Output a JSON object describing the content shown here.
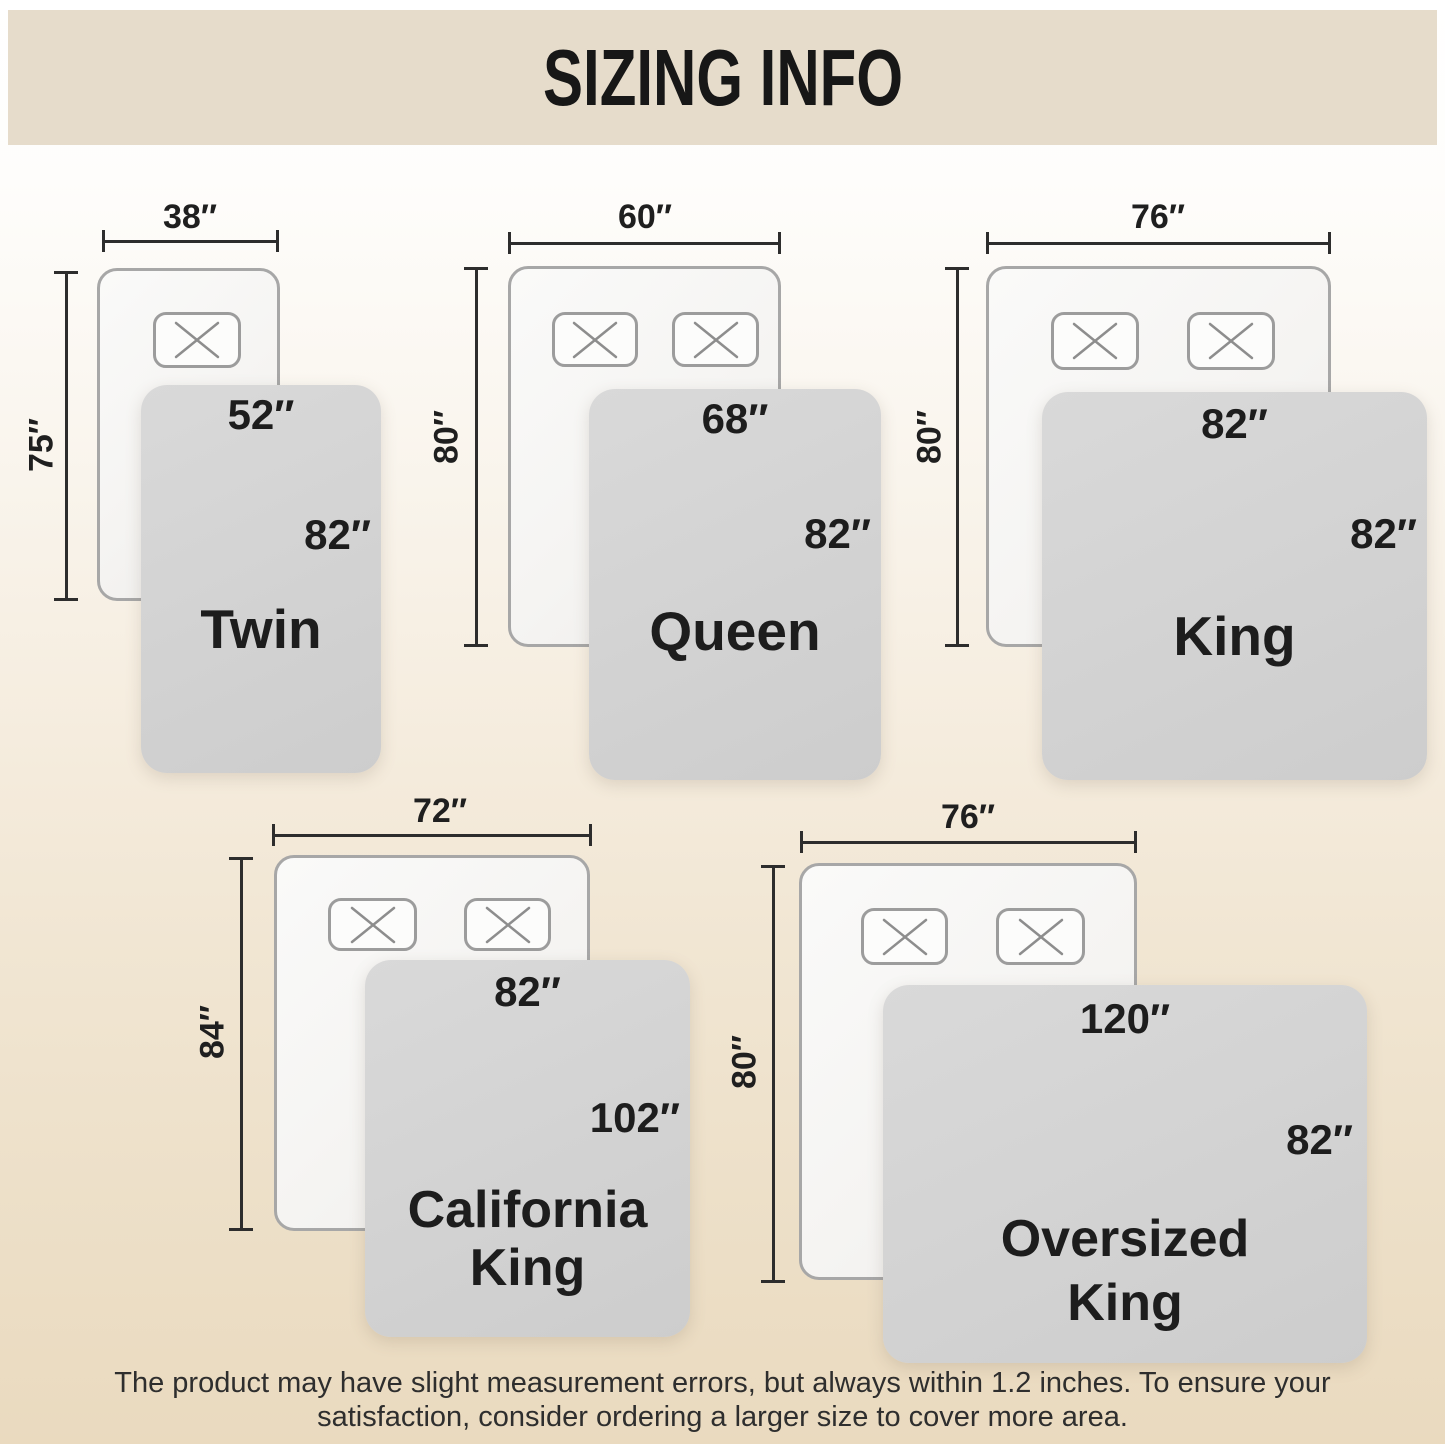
{
  "header": {
    "title": "SIZING INFO"
  },
  "diagrams": [
    {
      "name": "Twin",
      "bed_width": "38″",
      "bed_length": "75″",
      "blanket_width": "52″",
      "blanket_length": "82″"
    },
    {
      "name": "Queen",
      "bed_width": "60″",
      "bed_length": "80″",
      "blanket_width": "68″",
      "blanket_length": "82″"
    },
    {
      "name": "King",
      "bed_width": "76″",
      "bed_length": "80″",
      "blanket_width": "82″",
      "blanket_length": "82″"
    },
    {
      "name": "California King",
      "name_line1": "California",
      "name_line2": "King",
      "bed_width": "72″",
      "bed_length": "84″",
      "blanket_width": "82″",
      "blanket_length": "102″"
    },
    {
      "name": "Oversized King",
      "name_line1": "Oversized",
      "name_line2": "King",
      "bed_width": "76″",
      "bed_length": "80″",
      "blanket_width": "120″",
      "blanket_length": "82″"
    }
  ],
  "footer": {
    "line1": "The product may have slight measurement errors, but always within 1.2 inches. To ensure your",
    "line2": "satisfaction, consider ordering a larger size to cover more area."
  },
  "colors": {
    "header_band": "#e6dccb",
    "title_text": "#171717",
    "dim_text": "#1f1f1f",
    "dim_line": "#2d2d2d",
    "bed_fill_light": "#fafaf9",
    "bed_fill_dark": "#eeedeb",
    "bed_border": "#a7a7a7",
    "pillow_fill": "#fcfcfb",
    "pillow_border": "#9c9c9c",
    "pillow_x": "#8d8d8d",
    "blanket_fill_light": "#d9d9d9",
    "blanket_fill_dark": "#cdcdcd",
    "blanket_text": "#1d1d1d",
    "footer_text": "#2e2e2e",
    "page_top": "#ffffff",
    "page_bottom": "#eadabf"
  }
}
